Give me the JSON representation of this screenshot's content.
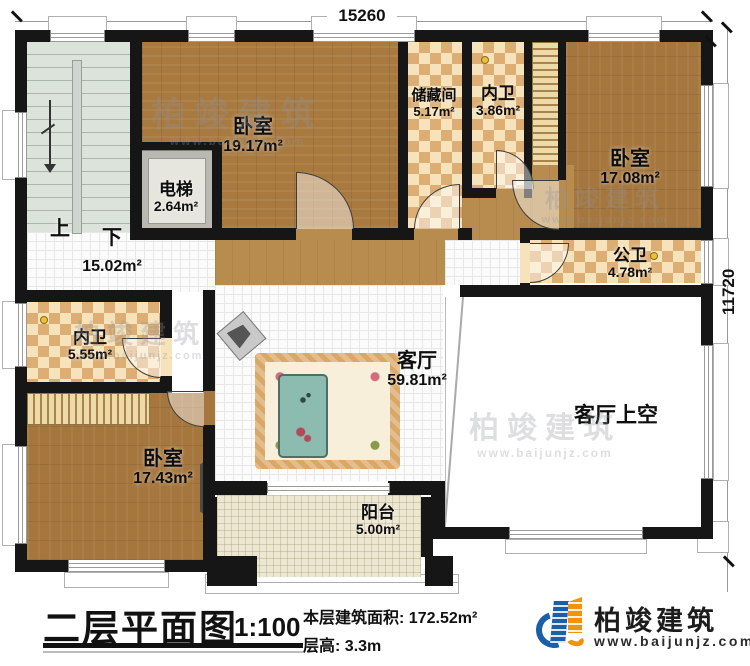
{
  "dimensions": {
    "top": "15260",
    "right": "11720"
  },
  "rooms": {
    "bedroom_top_left": {
      "name": "卧室",
      "area": "19.17m²"
    },
    "elevator": {
      "name": "电梯",
      "area": "2.64m²"
    },
    "storage": {
      "name": "储藏间",
      "area": "5.17m²"
    },
    "bath_top": {
      "name": "内卫",
      "area": "3.86m²"
    },
    "bedroom_top_right": {
      "name": "卧室",
      "area": "17.08m²"
    },
    "public_bath": {
      "name": "公卫",
      "area": "4.78m²"
    },
    "hall": {
      "up": "上",
      "down": "下",
      "area": "15.02m²"
    },
    "bath_left": {
      "name": "内卫",
      "area": "5.55m²"
    },
    "bedroom_bottom_left": {
      "name": "卧室",
      "area": "17.43m²"
    },
    "living_room": {
      "name": "客厅",
      "area": "59.81m²"
    },
    "living_void": {
      "name": "客厅上空"
    },
    "balcony": {
      "name": "阳台",
      "area": "5.00m²"
    }
  },
  "title_block": {
    "title": "二层平面图",
    "scale": "1:100",
    "floor_area_label": "本层建筑面积:",
    "floor_area_value": "172.52m²",
    "floor_height_label": "层高:",
    "floor_height_value": "3.3m"
  },
  "logo": {
    "company": "柏竣建筑",
    "website": "www.baijunjz.com"
  },
  "watermark": {
    "text": "柏竣建筑",
    "url": "www.baijunjz.com"
  },
  "colors": {
    "wall": "#161616",
    "wood_floor": "#a97a40",
    "tile_floor": "#fbfbfb",
    "checker_dark": "#dcae74",
    "checker_light": "#f6e3bb",
    "stair": "#dce3db",
    "balcony": "#ece7d1",
    "bed_blue": "#72c4d8",
    "sofa_orange": "#e8b183",
    "logo_blue": "#1a5fa8",
    "logo_orange": "#f2930d"
  }
}
